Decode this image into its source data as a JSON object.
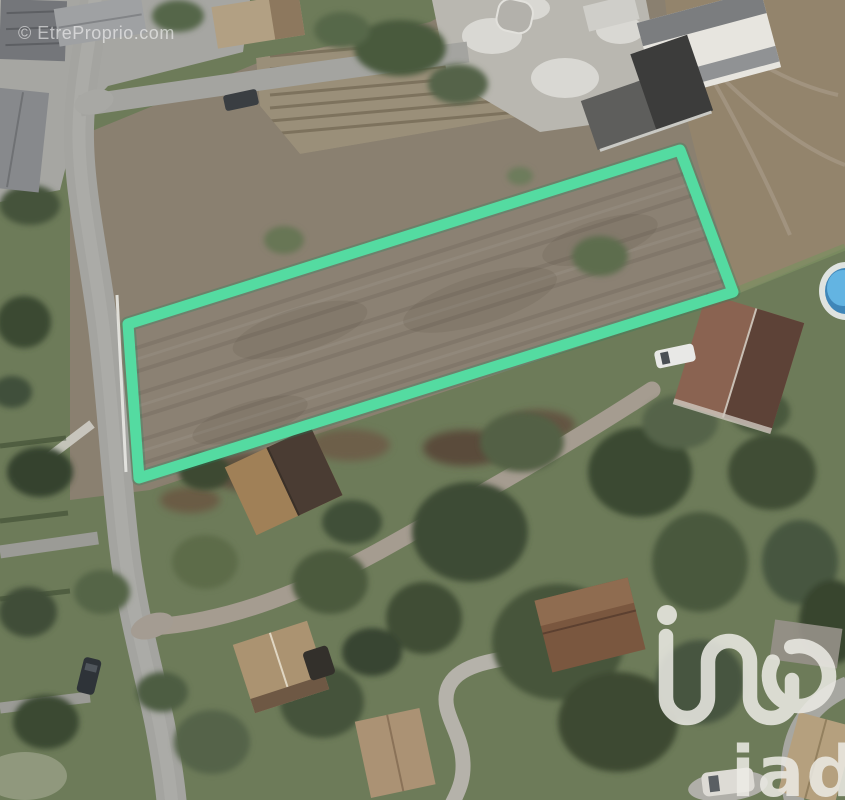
{
  "watermark": {
    "text": "© EtreProprio.com"
  },
  "brand": {
    "logo_text": "iad",
    "logo_monogram": "iad-monogram"
  },
  "parcel": {
    "label": "highlighted-building-plot",
    "outline_color": "#54dba1",
    "corners_px": [
      [
        128,
        324
      ],
      [
        680,
        150
      ],
      [
        733,
        292
      ],
      [
        139,
        478
      ]
    ]
  },
  "scene": {
    "type": "satellite-aerial-photo",
    "features": [
      "main-road",
      "top-road",
      "diagonal-driveway",
      "plowed-fields",
      "highlighted-parcel",
      "barn",
      "houses",
      "trees",
      "swimming-pool",
      "cars",
      "gravel-yard"
    ]
  },
  "colors": {
    "parcel_green": "#54dba1",
    "lawn_green": "#6d7b59",
    "field_brown": "#8a8070",
    "field_tan": "#9a8f79",
    "field_right": "#93846c",
    "parcel_field": "#8b8173",
    "road_gray": "#a4a4a0",
    "driveway_gray": "#a59c90",
    "gravel_light": "#b9b7b0",
    "tree_dark": "#3e4c34",
    "roof_rust": "#8a6351",
    "pool_blue": "#63b4e2",
    "watermark_white": "rgba(255,255,255,0.55)",
    "logo_white": "#edece6"
  }
}
